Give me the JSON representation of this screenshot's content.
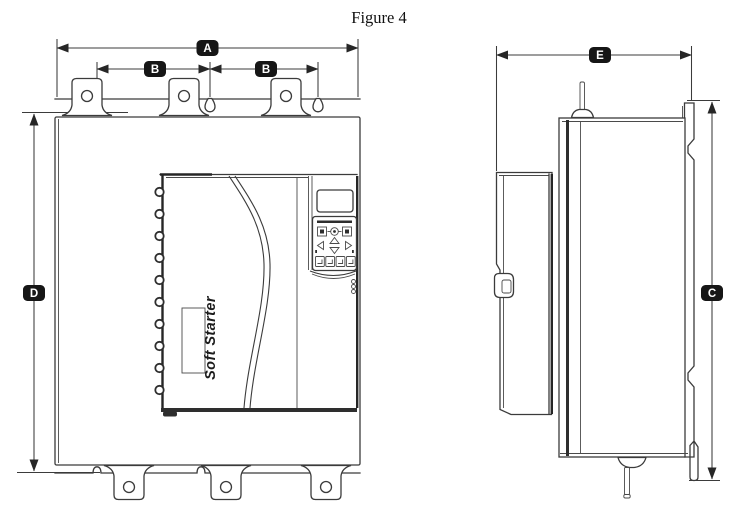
{
  "figure": {
    "title": "Figure 4"
  },
  "views": {
    "front": {
      "dimensions": {
        "width": "A",
        "hole_spacing_left": "B",
        "hole_spacing_right": "B",
        "height": "D"
      },
      "product_label": "Soft Starter"
    },
    "side": {
      "dimensions": {
        "depth": "E",
        "mounting_height": "C"
      }
    }
  },
  "colors": {
    "background": "#ffffff",
    "line": "#3b3b3b",
    "dark_fill": "#2e2e2e",
    "badge_background": "#161616",
    "badge_text": "#ffffff"
  }
}
